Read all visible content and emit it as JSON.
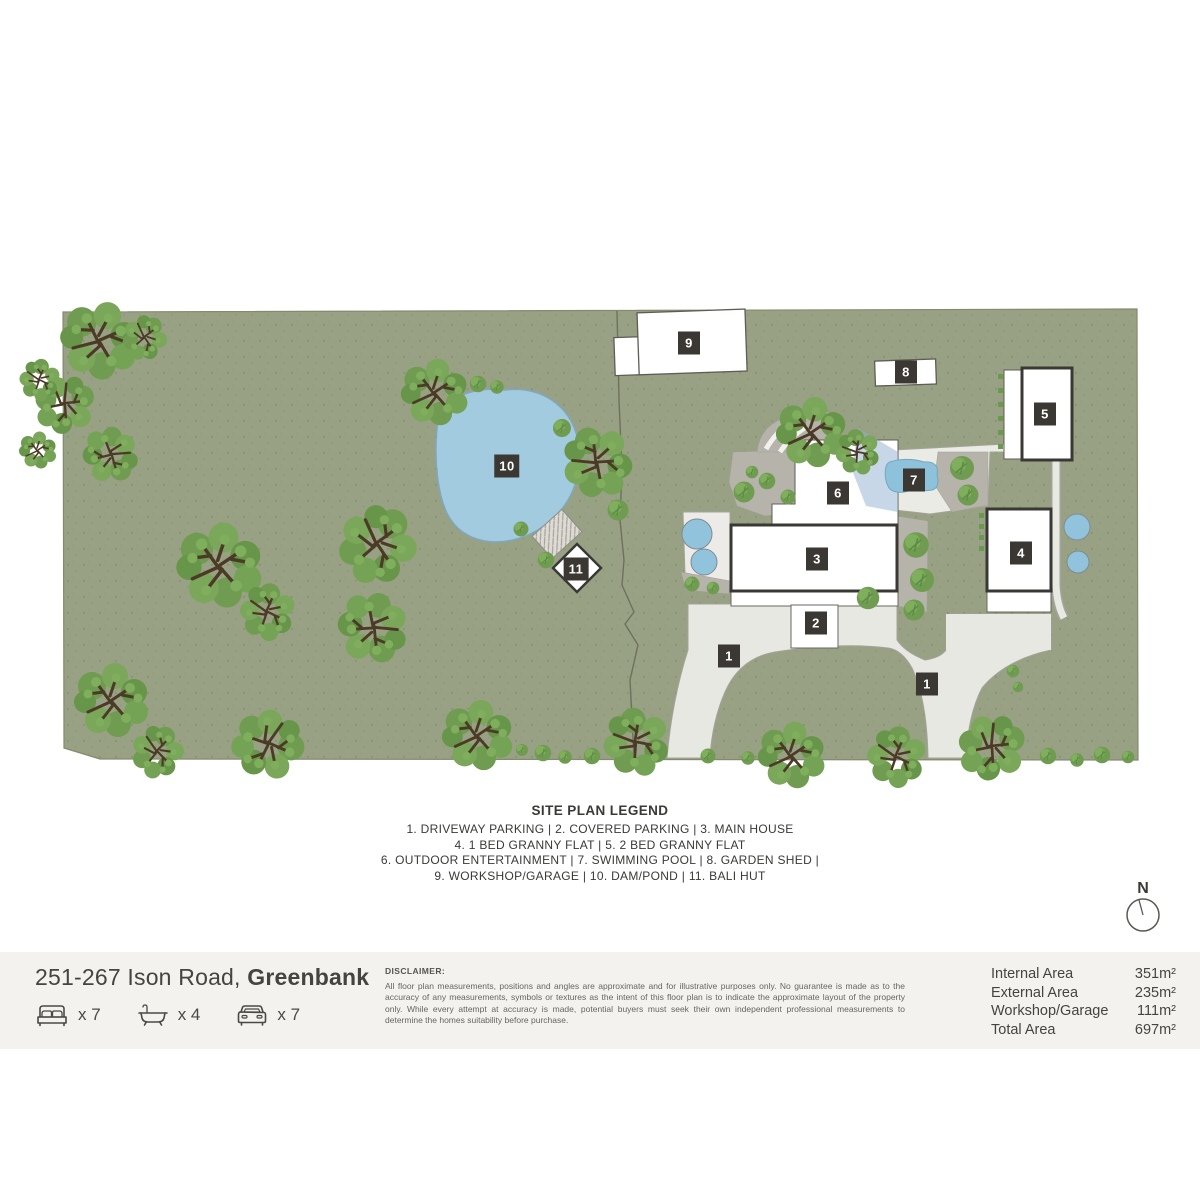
{
  "site_plan": {
    "legend": {
      "title": "SITE PLAN LEGEND",
      "lines": [
        "1. DRIVEWAY PARKING | 2. COVERED PARKING | 3. MAIN HOUSE",
        "4. 1 BED GRANNY FLAT | 5. 2 BED GRANNY FLAT",
        "6. OUTDOOR ENTERTAINMENT | 7. SWIMMING POOL | 8. GARDEN SHED |",
        "9. WORKSHOP/GARAGE | 10. DAM/POND | 11. BALI HUT"
      ]
    },
    "markers": [
      {
        "n": "9",
        "x": 689,
        "y": 343
      },
      {
        "n": "8",
        "x": 906,
        "y": 372
      },
      {
        "n": "5",
        "x": 1045,
        "y": 414
      },
      {
        "n": "7",
        "x": 914,
        "y": 480
      },
      {
        "n": "6",
        "x": 838,
        "y": 493
      },
      {
        "n": "10",
        "x": 507,
        "y": 466
      },
      {
        "n": "11",
        "x": 576,
        "y": 569
      },
      {
        "n": "3",
        "x": 817,
        "y": 559
      },
      {
        "n": "2",
        "x": 816,
        "y": 623
      },
      {
        "n": "4",
        "x": 1021,
        "y": 553
      },
      {
        "n": "1",
        "x": 729,
        "y": 656
      },
      {
        "n": "1",
        "x": 927,
        "y": 684
      }
    ],
    "compass_label": "N"
  },
  "footer": {
    "address_line": "251-267 Ison Road, ",
    "address_suburb": "Greenbank",
    "features": [
      {
        "icon": "bed-icon",
        "count": "x 7"
      },
      {
        "icon": "bath-icon",
        "count": "x 4"
      },
      {
        "icon": "car-icon",
        "count": "x 7"
      }
    ],
    "disclaimer_title": "DISCLAIMER:",
    "disclaimer_body": "All floor plan measurements, positions and angles are approximate and for illustrative purposes only. No guarantee is made as to the accuracy of any measurements, symbols or textures as the intent of this floor plan is to indicate the approximate layout of the property only. While every attempt at accuracy is made, potential buyers must seek their own independent professional measurements to determine the homes suitability before purchase.",
    "areas": [
      {
        "label": "Internal Area",
        "value": "351m²"
      },
      {
        "label": "External Area",
        "value": "235m²"
      },
      {
        "label": "Workshop/Garage",
        "value": "111m²"
      },
      {
        "label": "Total Area",
        "value": "697m²"
      }
    ]
  },
  "colors": {
    "land": "#99a184",
    "tree_canopy": "#6f9c50",
    "branch": "#4b3a26",
    "water": "#a3cbe0",
    "pool": "#8ec2da",
    "driveway": "#e8e8e3",
    "garden_bed": "#b6b3ab",
    "marker_bg": "#3b3733",
    "footer_bg": "#f4f2ef"
  }
}
